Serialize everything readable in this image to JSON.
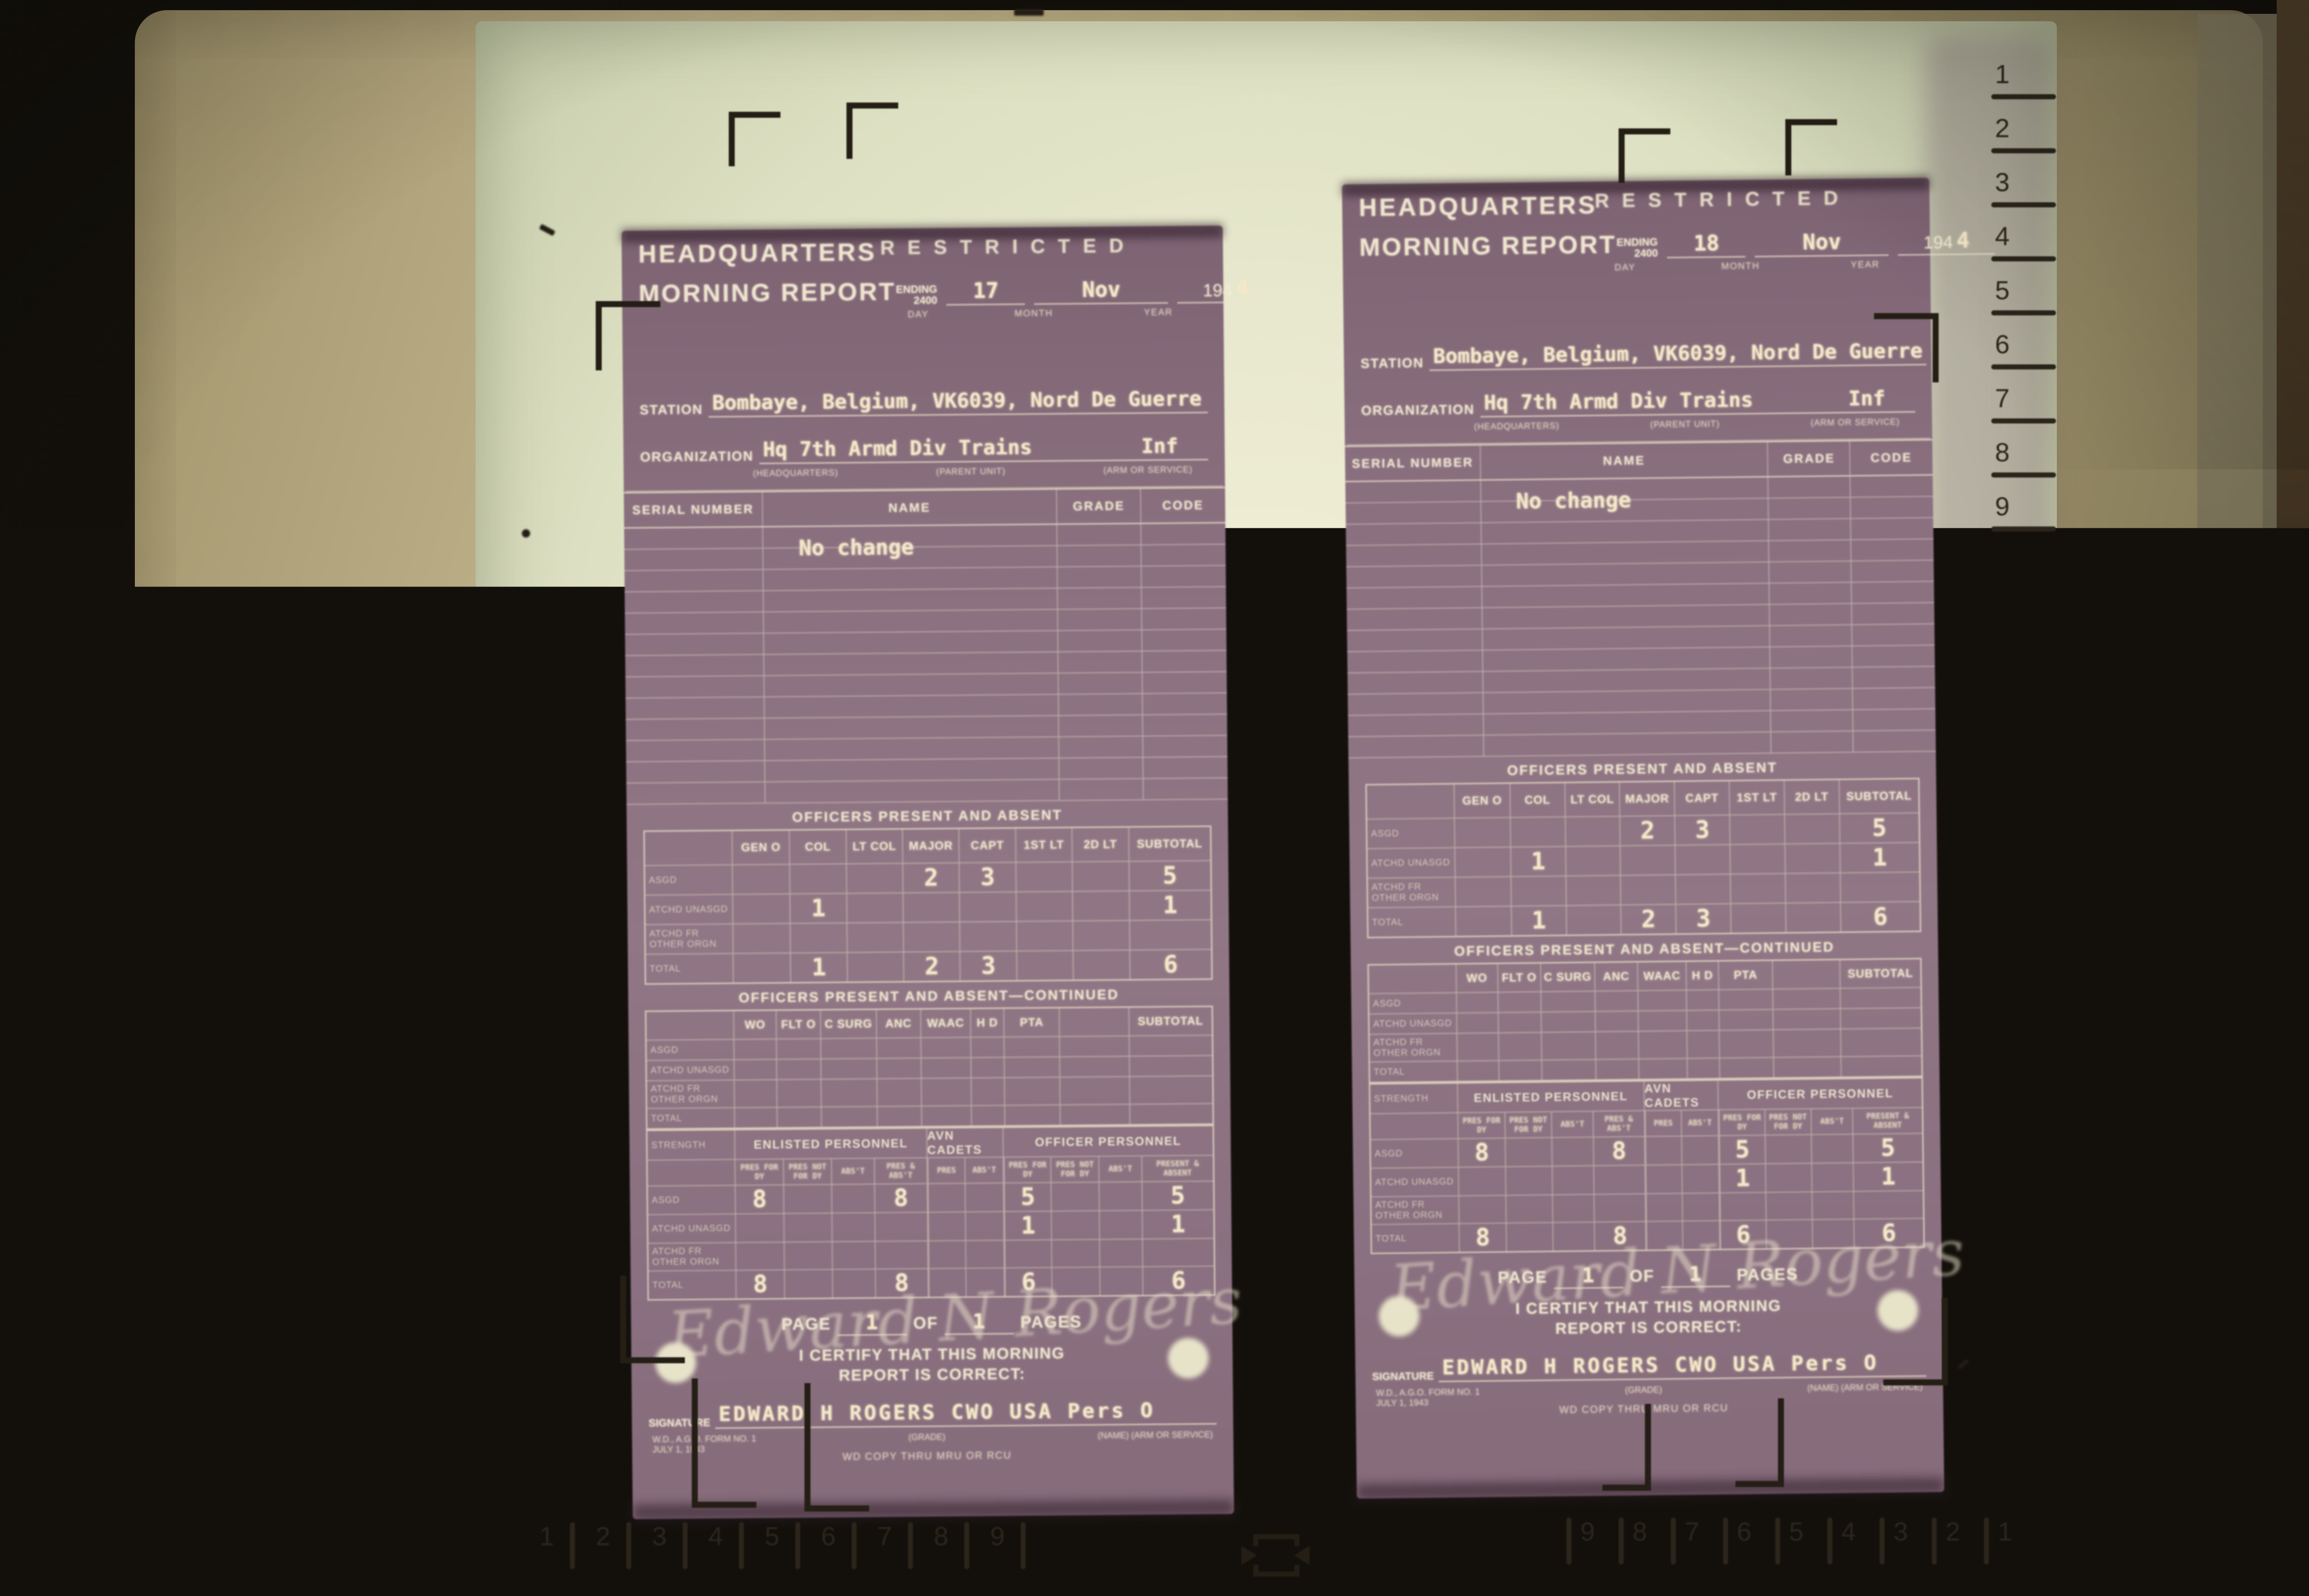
{
  "screen": {
    "rol_button": "Rol",
    "lgl_label": "LGL",
    "ltr_label": "LTR",
    "ruler_right_top": [
      "1",
      "2",
      "3",
      "4",
      "5",
      "6",
      "7",
      "8",
      "9"
    ],
    "ruler_right_bottom": [
      "9",
      "8",
      "7",
      "6",
      "5",
      "4",
      "3",
      "2",
      "1"
    ],
    "ruler_bottom_left": [
      "1",
      "2",
      "3",
      "4",
      "5",
      "6",
      "7",
      "8",
      "9"
    ],
    "ruler_bottom_right": [
      "9",
      "8",
      "7",
      "6",
      "5",
      "4",
      "3",
      "2",
      "1"
    ],
    "icons": {
      "registration_corner": "L-shaped corner bracket mark",
      "centering_vertical": "bracket with arrows pointing inward vertically",
      "centering_horizontal": "bracket with arrows pointing inward horizontally"
    }
  },
  "form": {
    "headquarters": "HEADQUARTERS",
    "morning_report": "MORNING REPORT",
    "restricted": "RESTRICTED",
    "ending": "ENDING",
    "ending_time": "2400",
    "day_label": "DAY",
    "month_label": "MONTH",
    "year_label": "YEAR",
    "year_prefix": "194",
    "station_label": "STATION",
    "organization_label": "ORGANIZATION",
    "headquarters_small": "(HEADQUARTERS)",
    "parent_unit_small": "(PARENT UNIT)",
    "arm_service_small": "(ARM OR SERVICE)",
    "roster_headers": [
      "SERIAL NUMBER",
      "NAME",
      "GRADE",
      "CODE"
    ],
    "officers_title": "OFFICERS PRESENT AND ABSENT",
    "officers_cols": [
      "GEN O",
      "COL",
      "LT COL",
      "MAJOR",
      "CAPT",
      "1ST LT",
      "2D LT",
      "SUBTOTAL"
    ],
    "officers_cont_title": "OFFICERS PRESENT AND ABSENT—CONTINUED",
    "officers_cont_cols": [
      "WO",
      "FLT O",
      "C SURG",
      "ANC",
      "WAAC",
      "H D",
      "PTA",
      "",
      "SUBTOTAL"
    ],
    "row_labels": [
      "ASGD",
      "ATCHD UNASGD",
      "ATCHD FR OTHER ORGN",
      "TOTAL"
    ],
    "strength_label": "STRENGTH",
    "strength_groups": [
      "ENLISTED PERSONNEL",
      "AVN CADETS",
      "OFFICER PERSONNEL"
    ],
    "strength_cols": [
      "PRES FOR DY",
      "PRES NOT FOR DY",
      "ABS'T",
      "PRES & ABS'T",
      "PRES",
      "ABS'T",
      "PRES FOR DY",
      "PRES NOT FOR DY",
      "ABS'T",
      "PRESENT & ABSENT"
    ],
    "page_label": "PAGE",
    "of_label": "OF",
    "pages_label": "PAGES",
    "certify_line1": "I CERTIFY THAT THIS MORNING",
    "certify_line2": "REPORT IS CORRECT:",
    "signature_label": "SIGNATURE",
    "grade_small": "(GRADE)",
    "form_no_line1": "W.D., A.G.O. FORM NO. 1",
    "form_no_line2": "JULY 1, 1943",
    "wd_copy": "WD COPY THRU MRU OR RCU",
    "name_arm_small": "(NAME)   (ARM OR SERVICE)"
  },
  "doc_left": {
    "ending_day": "17",
    "ending_month": "Nov",
    "year_digit": "4",
    "station": "Bombaye, Belgium, VK6039, Nord De Guerre",
    "organization": "Hq 7th Armd Div Trains",
    "arm": "Inf",
    "roster_note": "No change",
    "officers": {
      "asgd": [
        "",
        "",
        "",
        "2",
        "3",
        "",
        "",
        "5"
      ],
      "atchd_unasgd": [
        "",
        "1",
        "",
        "",
        "",
        "",
        "",
        "1"
      ],
      "atchd_fr_other_orgn": [
        "",
        "",
        "",
        "",
        "",
        "",
        "",
        ""
      ],
      "total": [
        "",
        "1",
        "",
        "2",
        "3",
        "",
        "",
        "6"
      ]
    },
    "officers_cont": {
      "asgd": [
        "",
        "",
        "",
        "",
        "",
        "",
        "",
        "",
        ""
      ],
      "atchd_unasgd": [
        "",
        "",
        "",
        "",
        "",
        "",
        "",
        "",
        ""
      ],
      "atchd_fr_other_orgn": [
        "",
        "",
        "",
        "",
        "",
        "",
        "",
        "",
        ""
      ],
      "total": [
        "",
        "",
        "",
        "",
        "",
        "",
        "",
        "",
        ""
      ]
    },
    "strength": {
      "asgd": [
        "8",
        "",
        "",
        "8",
        "",
        "",
        "5",
        "",
        "",
        "5"
      ],
      "atchd_unasgd": [
        "",
        "",
        "",
        "",
        "",
        "",
        "1",
        "",
        "",
        "1"
      ],
      "atchd_fr_other_orgn": [
        "",
        "",
        "",
        "",
        "",
        "",
        "",
        "",
        "",
        ""
      ],
      "total": [
        "8",
        "",
        "",
        "8",
        "",
        "",
        "6",
        "",
        "",
        "6"
      ]
    },
    "page_no": "1",
    "pages_total": "1",
    "signature_script": "Edward N Rogers",
    "signature_typed": "EDWARD H ROGERS CWO USA Pers O"
  },
  "doc_right": {
    "ending_day": "18",
    "ending_month": "Nov",
    "year_digit": "4",
    "station": "Bombaye, Belgium, VK6039, Nord De Guerre",
    "organization": "Hq 7th Armd Div Trains",
    "arm": "Inf",
    "roster_note": "No change",
    "officers": {
      "asgd": [
        "",
        "",
        "",
        "2",
        "3",
        "",
        "",
        "5"
      ],
      "atchd_unasgd": [
        "",
        "1",
        "",
        "",
        "",
        "",
        "",
        "1"
      ],
      "atchd_fr_other_orgn": [
        "",
        "",
        "",
        "",
        "",
        "",
        "",
        ""
      ],
      "total": [
        "",
        "1",
        "",
        "2",
        "3",
        "",
        "",
        "6"
      ]
    },
    "officers_cont": {
      "asgd": [
        "",
        "",
        "",
        "",
        "",
        "",
        "",
        "",
        ""
      ],
      "atchd_unasgd": [
        "",
        "",
        "",
        "",
        "",
        "",
        "",
        "",
        ""
      ],
      "atchd_fr_other_orgn": [
        "",
        "",
        "",
        "",
        "",
        "",
        "",
        "",
        ""
      ],
      "total": [
        "",
        "",
        "",
        "",
        "",
        "",
        "",
        "",
        ""
      ]
    },
    "strength": {
      "asgd": [
        "8",
        "",
        "",
        "8",
        "",
        "",
        "5",
        "",
        "",
        "5"
      ],
      "atchd_unasgd": [
        "",
        "",
        "",
        "",
        "",
        "",
        "1",
        "",
        "",
        "1"
      ],
      "atchd_fr_other_orgn": [
        "",
        "",
        "",
        "",
        "",
        "",
        "",
        "",
        "",
        ""
      ],
      "total": [
        "8",
        "",
        "",
        "8",
        "",
        "",
        "6",
        "",
        "",
        "6"
      ]
    },
    "page_no": "1",
    "pages_total": "1",
    "signature_script": "Edward N Rogers",
    "signature_typed": "EDWARD H ROGERS CWO USA Pers O"
  }
}
